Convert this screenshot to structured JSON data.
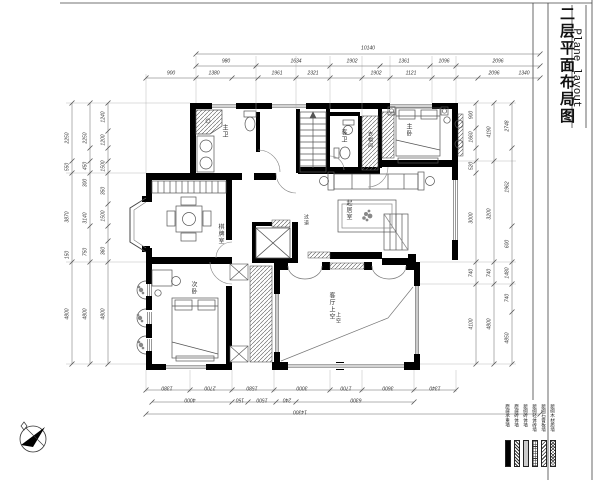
{
  "sheet": {
    "title_cn": "二层平面布局图",
    "title_en": "Plane layout"
  },
  "legend": {
    "items": [
      {
        "label": "原建承重墙",
        "pattern": "solid-black"
      },
      {
        "label": "原建砖体墙",
        "pattern": "diagonal-hatch"
      },
      {
        "label": "新砌砖体墙",
        "pattern": "dense-dots"
      },
      {
        "label": "新砌轻体砖墙",
        "pattern": "grid"
      },
      {
        "label": "新砌石膏板墙",
        "pattern": "light-diagonal"
      },
      {
        "label": "新砌木材质墙",
        "pattern": "crosshatch"
      }
    ]
  },
  "rooms": {
    "master_bath": "主卫",
    "guest_bath": "客卫",
    "cloakroom": "衣帽间",
    "master_bedroom": "主卧",
    "lounge": "起居室",
    "corridor": "过道",
    "game_room": "棋牌室",
    "bedroom": "次卧",
    "void": "客厅上空",
    "void_note": "上空"
  },
  "dimensions": {
    "top_total": "10140",
    "top_row2": [
      "980",
      "1634",
      "1902",
      "1361",
      "1096",
      "2096"
    ],
    "top_row3": [
      "900",
      "1380",
      "1961",
      "2321",
      "1902",
      "1121",
      "2096",
      "1340"
    ],
    "left_outer": [
      "2250",
      "550",
      "3870",
      "150",
      "4800"
    ],
    "left_mid": [
      "2250",
      "450",
      "300",
      "3140",
      "750",
      "4800"
    ],
    "left_inner": [
      "1240",
      "1200",
      "1500",
      "350",
      "1500",
      "360",
      "4800"
    ],
    "right_inner": [
      "900",
      "1660",
      "520",
      "3000",
      "740",
      "4100"
    ],
    "right_mid": [
      "4190",
      "3200",
      "740",
      "4800"
    ],
    "right_outer": [
      "2748",
      "1962",
      "600",
      "1480",
      "740",
      "4850"
    ],
    "bottom_row1": [
      "1380",
      "2700",
      "1580",
      "3000",
      "1700",
      "3600",
      "1340"
    ],
    "bottom_row2": [
      "4000",
      "150",
      "1500",
      "240",
      "6300"
    ],
    "bottom_total": "14300"
  },
  "colors": {
    "ink": "#000000",
    "line": "#555555",
    "dim": "#888888"
  }
}
